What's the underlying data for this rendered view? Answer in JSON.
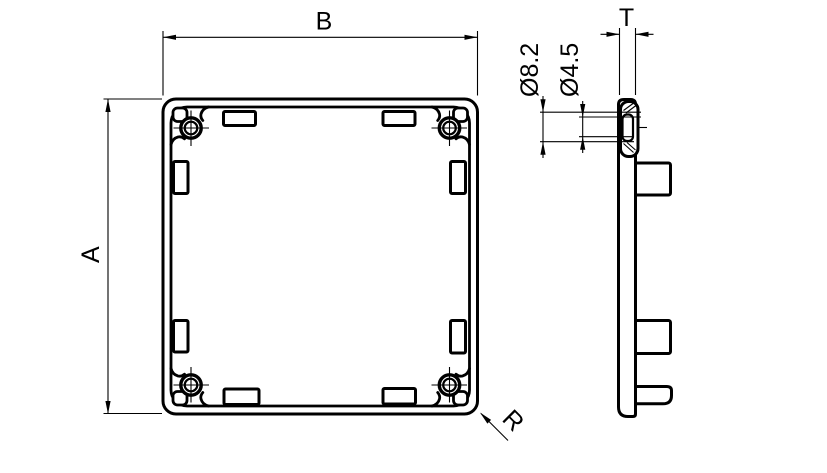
{
  "drawing": {
    "background_color": "#ffffff",
    "line_color": "#000000",
    "views": {
      "front": "end-cap-front-view",
      "side": "end-cap-side-view"
    },
    "dims": {
      "b": "B",
      "a": "A",
      "t": "T",
      "d_outer": "Ø8.2",
      "d_inner": "Ø4.5",
      "r": "R"
    }
  }
}
